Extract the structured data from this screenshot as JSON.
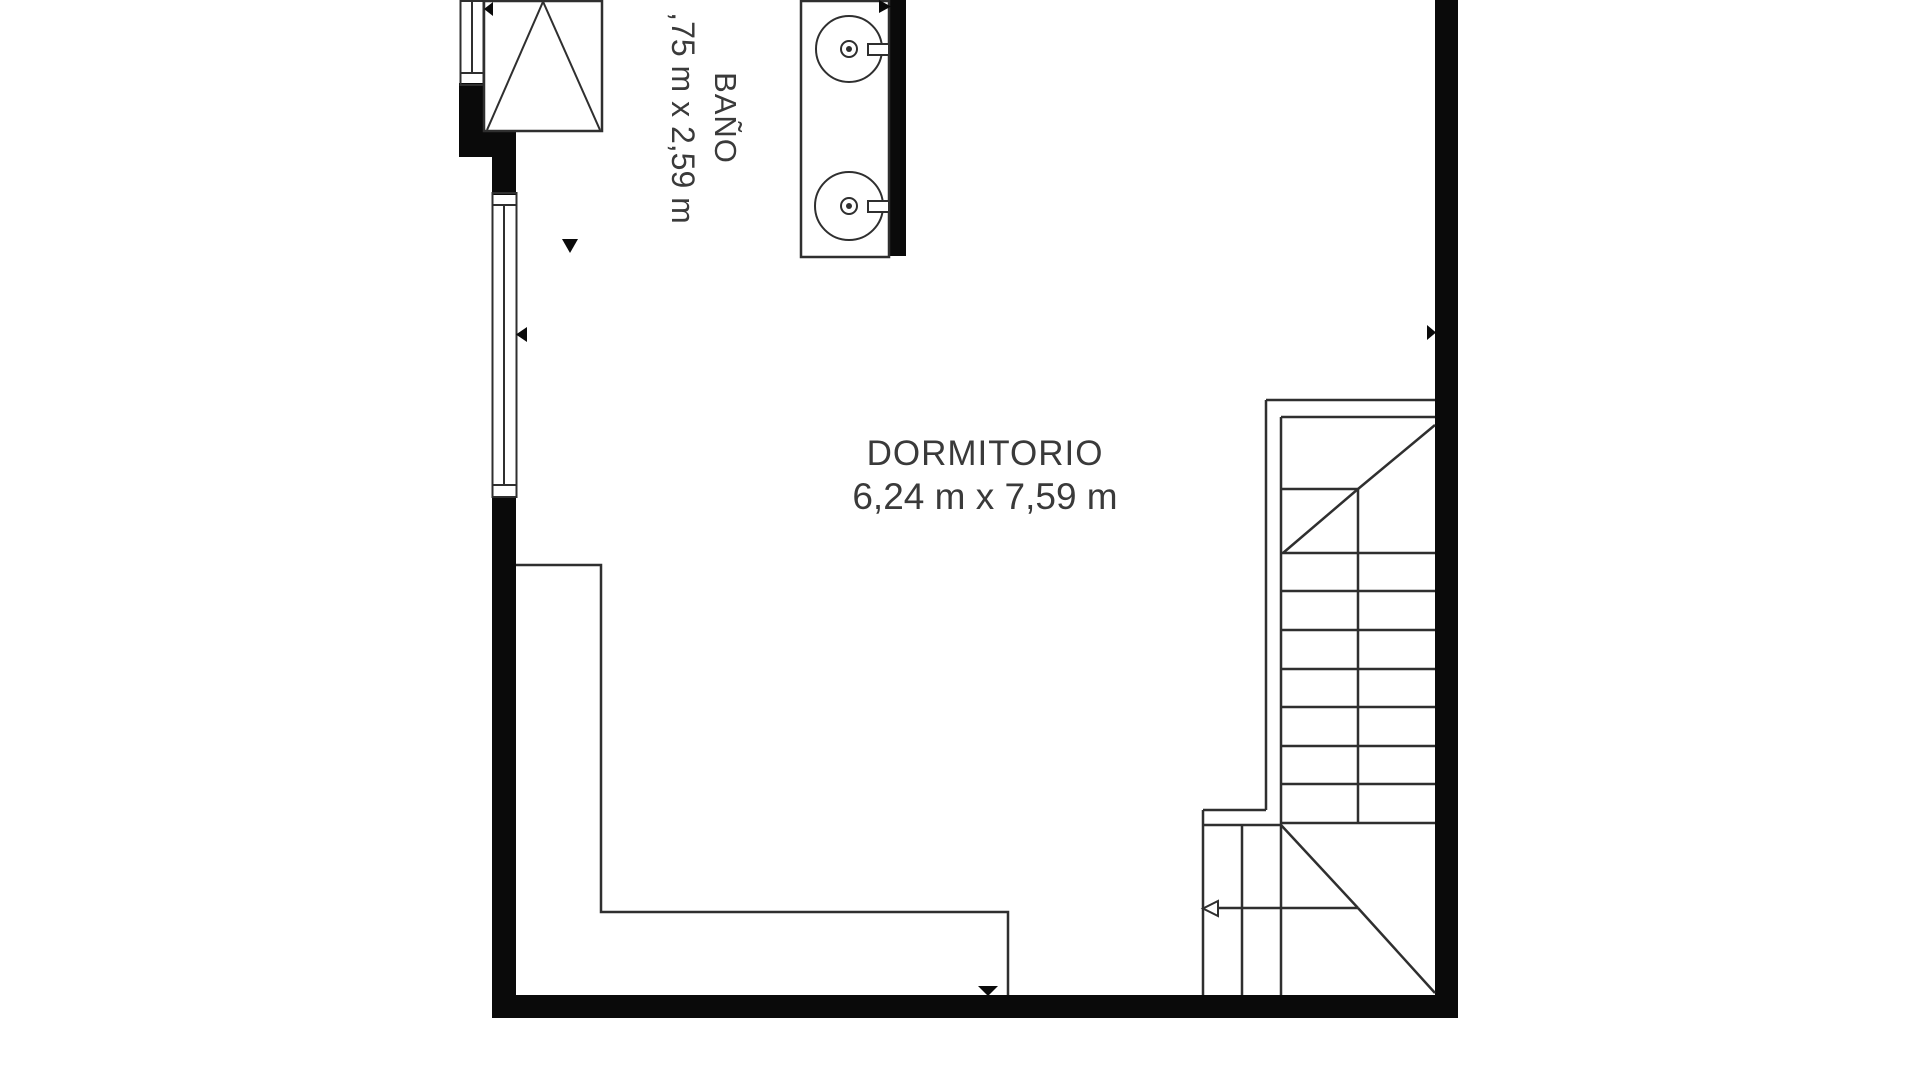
{
  "colors": {
    "wall": "#0a0a0a",
    "line": "#2f2f2f",
    "text": "#3a3a3a",
    "background": "#ffffff"
  },
  "rooms": {
    "bathroom": {
      "label": "BAÑO",
      "dimensions": ",75 m x 2,59 m"
    },
    "bedroom": {
      "label": "DORMITORIO",
      "dimensions": "6,24 m x 7,59 m"
    }
  },
  "fixtures": {
    "icons": [
      "sink-icon",
      "faucet-icon",
      "stairs-icon",
      "door-swing-icon",
      "window-icon",
      "direction-arrow-icon"
    ],
    "sink_count": 2
  }
}
